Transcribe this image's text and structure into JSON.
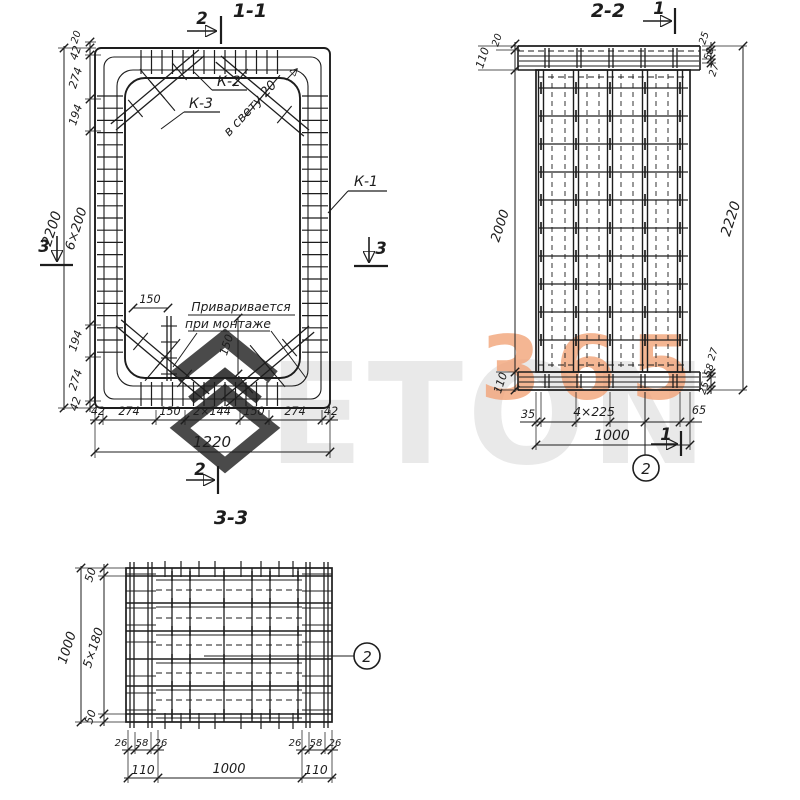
{
  "s11": {
    "title": "1-1",
    "cut_top": "2",
    "cut_bottom": "2",
    "cut_left": "3",
    "cut_right": "3",
    "k1": "К-1",
    "k2": "К-2",
    "k3": "К-3",
    "clear": "в свету 20",
    "weld1": "Приваривается",
    "weld2": "при монтаже",
    "stub_h": "150",
    "stub_v": "150",
    "left": [
      "20",
      "42",
      "274",
      "194",
      "6×200",
      "194",
      "274",
      "42"
    ],
    "left_overall": "2200",
    "bottom": [
      "42",
      "274",
      "150",
      "2×144",
      "150",
      "274",
      "42"
    ],
    "bottom_overall": "1220"
  },
  "s22": {
    "title": "2-2",
    "cut_top": "1",
    "cut_bottom": "1",
    "callout": "2",
    "left": [
      "20",
      "110",
      "2000",
      "110"
    ],
    "right_top": [
      "25",
      "58",
      "27"
    ],
    "right_overall": "2220",
    "right_bottom": [
      "27",
      "58",
      "25"
    ],
    "bottom": [
      "35",
      "4×225",
      "65"
    ],
    "bottom_overall": "1000"
  },
  "s33": {
    "title": "3-3",
    "callout": "2",
    "left": [
      "50",
      "5×180",
      "50"
    ],
    "left_overall": "1000",
    "bottom_left_group": [
      "26",
      "58",
      "26"
    ],
    "bottom_right_group": [
      "26",
      "58",
      "26"
    ],
    "bottom": [
      "110",
      "1000",
      "110"
    ]
  },
  "watermark": {
    "gray_text": "ETON",
    "orange_text": "365"
  },
  "colors": {
    "ink": "#1d1d1d",
    "orange": "#f2a479",
    "gray": "#e9e9e9"
  }
}
